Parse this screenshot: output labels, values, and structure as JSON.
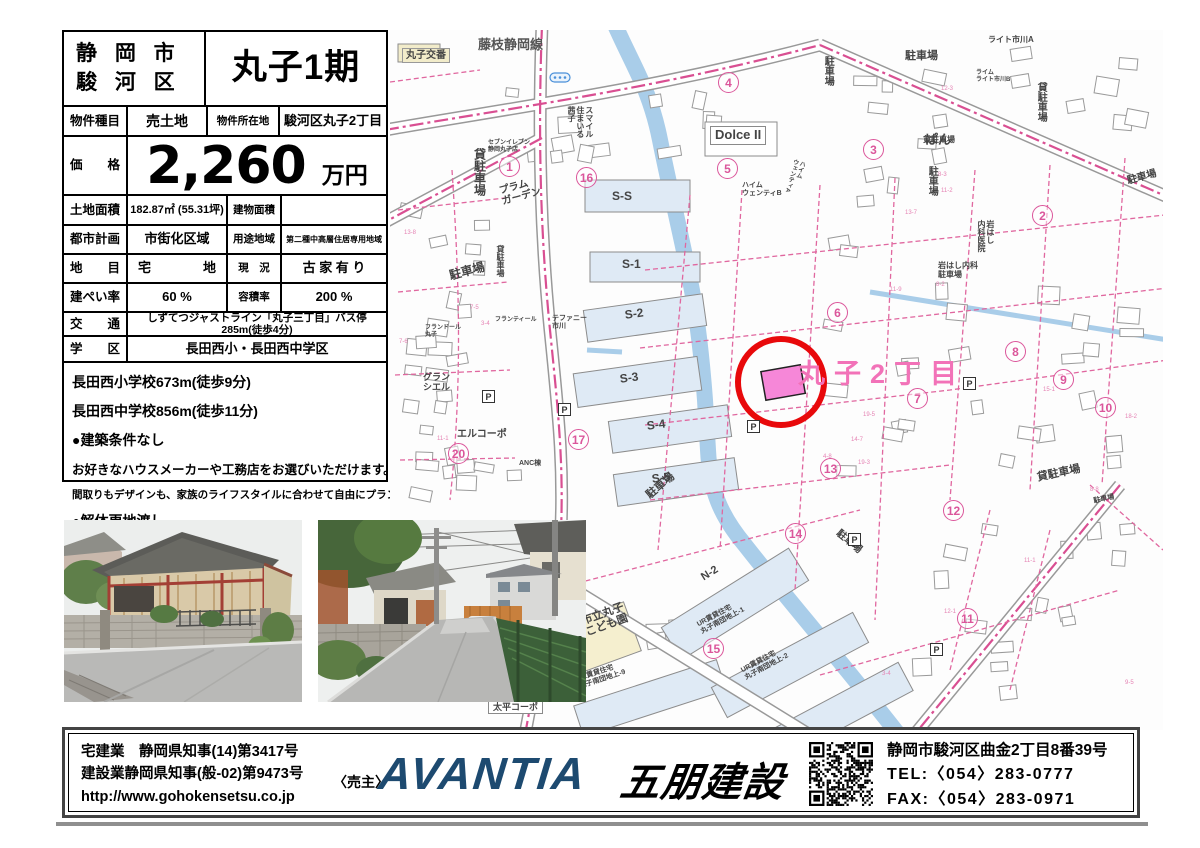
{
  "header": {
    "city": "静 岡 市",
    "ward": "駿 河 区",
    "project": "丸子1期"
  },
  "table": {
    "type_label": "物件種目",
    "type_value": "売土地",
    "loc_label": "物件所在地",
    "loc_value": "駿河区丸子2丁目",
    "price_label": "価　　格",
    "price_value": "2,260",
    "price_unit": "万円",
    "land_label": "土地面積",
    "land_value": "182.87㎡ (55.31坪)",
    "bldg_label": "建物面積",
    "bldg_value": "",
    "plan_label": "都市計画",
    "plan_value": "市街化区域",
    "use_label": "用途地域",
    "use_value": "第二種中高層住居専用地域",
    "lot_label": "地　　目",
    "lot_value": "宅　　　　地",
    "cond_label": "現　況",
    "cond_value": "古 家 有 り",
    "bcr_label": "建ぺい率",
    "bcr_value": "60 %",
    "far_label": "容積率",
    "far_value": "200 %",
    "access_label": "交　　通",
    "access_value": "しずてつジャストライン「丸子三丁目」バス停285m(徒歩4分)",
    "school_label": "学　　区",
    "school_value": "長田西小・長田西中学区"
  },
  "notes": [
    {
      "text": "長田西小学校673m(徒歩9分)",
      "size": 14
    },
    {
      "text": "長田西中学校856m(徒歩11分)",
      "size": 14
    },
    {
      "text": "●建築条件なし",
      "size": 14
    },
    {
      "text": "お好きなハウスメーカーや工務店をお選びいただけます。",
      "size": 12.5
    },
    {
      "text": "間取りもデザインも、家族のライフスタイルに合わせて自由にプランニング。",
      "size": 10.5
    },
    {
      "text": "●解体更地渡し",
      "size": 14
    }
  ],
  "map": {
    "area_label": "丸子2丁目",
    "p_glyph": "P",
    "labels": [
      {
        "t": "藤枝静岡線",
        "x": 88,
        "y": 8,
        "s": 13,
        "c": "#555"
      },
      {
        "t": "丸子交番",
        "x": 12,
        "y": 18,
        "s": 10,
        "bg": "beige"
      },
      {
        "t": "貸駐車場",
        "x": 82,
        "y": 118,
        "s": 12,
        "v": 1
      },
      {
        "t": "貸駐車場",
        "x": 105,
        "y": 215,
        "s": 8,
        "v": 1
      },
      {
        "t": "駐車場",
        "x": 58,
        "y": 240,
        "s": 12,
        "r": -15
      },
      {
        "t": "プラム\nガーデン",
        "x": 108,
        "y": 156,
        "s": 10,
        "r": -15
      },
      {
        "t": "セブンイレブン\n静岡丸子店",
        "x": 98,
        "y": 110,
        "s": 6
      },
      {
        "t": "スマイル\n住まいる\n茜子",
        "x": 176,
        "y": 76,
        "s": 8,
        "v": 1
      },
      {
        "t": "Dolce II",
        "x": 320,
        "y": 96,
        "s": 13,
        "bg": "white"
      },
      {
        "t": "ハイム\nウェンティB",
        "x": 352,
        "y": 152,
        "s": 7
      },
      {
        "t": "ハイム\nウェンティA",
        "x": 402,
        "y": 128,
        "s": 6,
        "v": 1,
        "r": 15
      },
      {
        "t": "ぱん",
        "x": 535,
        "y": 103,
        "s": 13
      },
      {
        "t": "ライト市川A",
        "x": 598,
        "y": 6,
        "s": 8
      },
      {
        "t": "ライム\nライト市川B",
        "x": 586,
        "y": 40,
        "s": 6
      },
      {
        "t": "駐車場",
        "x": 515,
        "y": 20,
        "s": 11
      },
      {
        "t": "駐車場",
        "x": 432,
        "y": 26,
        "s": 10,
        "v": 1
      },
      {
        "t": "貸駐車場",
        "x": 645,
        "y": 52,
        "s": 10,
        "v": 1
      },
      {
        "t": "貸駐車場",
        "x": 533,
        "y": 106,
        "s": 8
      },
      {
        "t": "駐車場",
        "x": 536,
        "y": 136,
        "s": 10,
        "v": 1
      },
      {
        "t": "駐車場",
        "x": 736,
        "y": 146,
        "s": 10,
        "r": -15
      },
      {
        "t": "岩はし\n内科医院",
        "x": 586,
        "y": 190,
        "s": 8,
        "v": 1
      },
      {
        "t": "岩はし内科\n駐車場",
        "x": 548,
        "y": 232,
        "s": 8
      },
      {
        "t": "S-S",
        "x": 222,
        "y": 160,
        "s": 12
      },
      {
        "t": "S-1",
        "x": 232,
        "y": 228,
        "s": 12
      },
      {
        "t": "S-2",
        "x": 234,
        "y": 279,
        "s": 12,
        "r": -8
      },
      {
        "t": "S-3",
        "x": 229,
        "y": 343,
        "s": 12,
        "r": -8
      },
      {
        "t": "S-4",
        "x": 256,
        "y": 390,
        "s": 12,
        "r": -8
      },
      {
        "t": "S-5",
        "x": 261,
        "y": 443,
        "s": 12,
        "r": -8
      },
      {
        "t": "テファニー\n市川",
        "x": 162,
        "y": 285,
        "s": 7
      },
      {
        "t": "フランティール",
        "x": 105,
        "y": 287,
        "s": 6
      },
      {
        "t": "フランドール\n丸子",
        "x": 35,
        "y": 295,
        "s": 6
      },
      {
        "t": "グラン\nシエル",
        "x": 33,
        "y": 342,
        "s": 9
      },
      {
        "t": "エルコーポ",
        "x": 67,
        "y": 399,
        "s": 10
      },
      {
        "t": "ANC棟",
        "x": 129,
        "y": 430,
        "s": 7
      },
      {
        "t": "駐車場",
        "x": 254,
        "y": 462,
        "s": 11,
        "r": -40
      },
      {
        "t": "駐車場",
        "x": 451,
        "y": 498,
        "s": 10,
        "r": 40
      },
      {
        "t": "市立丸子\nこども園",
        "x": 190,
        "y": 586,
        "s": 11,
        "r": -20
      },
      {
        "t": "N-2",
        "x": 309,
        "y": 543,
        "s": 11,
        "r": -32
      },
      {
        "t": "UR賃貸住宅\n丸子南団地上-9",
        "x": 186,
        "y": 646,
        "s": 7,
        "r": -18
      },
      {
        "t": "UR賃貸住宅\n丸子南団地上-1",
        "x": 306,
        "y": 592,
        "s": 7,
        "r": -28
      },
      {
        "t": "UR賃貸住宅\n丸子南団地上-2",
        "x": 350,
        "y": 638,
        "s": 7,
        "r": -28
      },
      {
        "t": "貸駐車場",
        "x": 646,
        "y": 442,
        "s": 11,
        "r": -12
      },
      {
        "t": "駐車場",
        "x": 703,
        "y": 468,
        "s": 7,
        "r": -12
      },
      {
        "t": "太平コーポ",
        "x": 98,
        "y": 670,
        "s": 9,
        "bg": "white"
      }
    ],
    "markers": [
      {
        "n": "1",
        "x": 119,
        "y": 136
      },
      {
        "n": "2",
        "x": 652,
        "y": 185
      },
      {
        "n": "3",
        "x": 483,
        "y": 119
      },
      {
        "n": "4",
        "x": 338,
        "y": 52
      },
      {
        "n": "5",
        "x": 337,
        "y": 138
      },
      {
        "n": "6",
        "x": 447,
        "y": 282
      },
      {
        "n": "7",
        "x": 527,
        "y": 368
      },
      {
        "n": "8",
        "x": 625,
        "y": 321
      },
      {
        "n": "9",
        "x": 673,
        "y": 349
      },
      {
        "n": "10",
        "x": 715,
        "y": 377
      },
      {
        "n": "11",
        "x": 577,
        "y": 588
      },
      {
        "n": "12",
        "x": 563,
        "y": 480
      },
      {
        "n": "13",
        "x": 440,
        "y": 438
      },
      {
        "n": "14",
        "x": 405,
        "y": 503
      },
      {
        "n": "15",
        "x": 323,
        "y": 618
      },
      {
        "n": "16",
        "x": 196,
        "y": 147
      },
      {
        "n": "17",
        "x": 188,
        "y": 409
      },
      {
        "n": "20",
        "x": 68,
        "y": 423
      }
    ],
    "p_icons": [
      {
        "x": 92,
        "y": 360
      },
      {
        "x": 168,
        "y": 373
      },
      {
        "x": 357,
        "y": 390
      },
      {
        "x": 573,
        "y": 347
      },
      {
        "x": 540,
        "y": 613
      },
      {
        "x": 458,
        "y": 503
      }
    ]
  },
  "footer": {
    "licenses": [
      "宅建業　静岡県知事(14)第3417号",
      "建設業静岡県知事(般-02)第9473号"
    ],
    "url": "http://www.gohokensetsu.co.jp",
    "seller_label": "〈売主〉",
    "brand": "AVANTIA",
    "company": "五朋建設",
    "address": "静岡市駿河区曲金2丁目8番39号",
    "tel": "TEL:〈054〉283-0777",
    "fax": "FAX:〈054〉283-0971",
    "brand_color": "#1d4a70"
  }
}
